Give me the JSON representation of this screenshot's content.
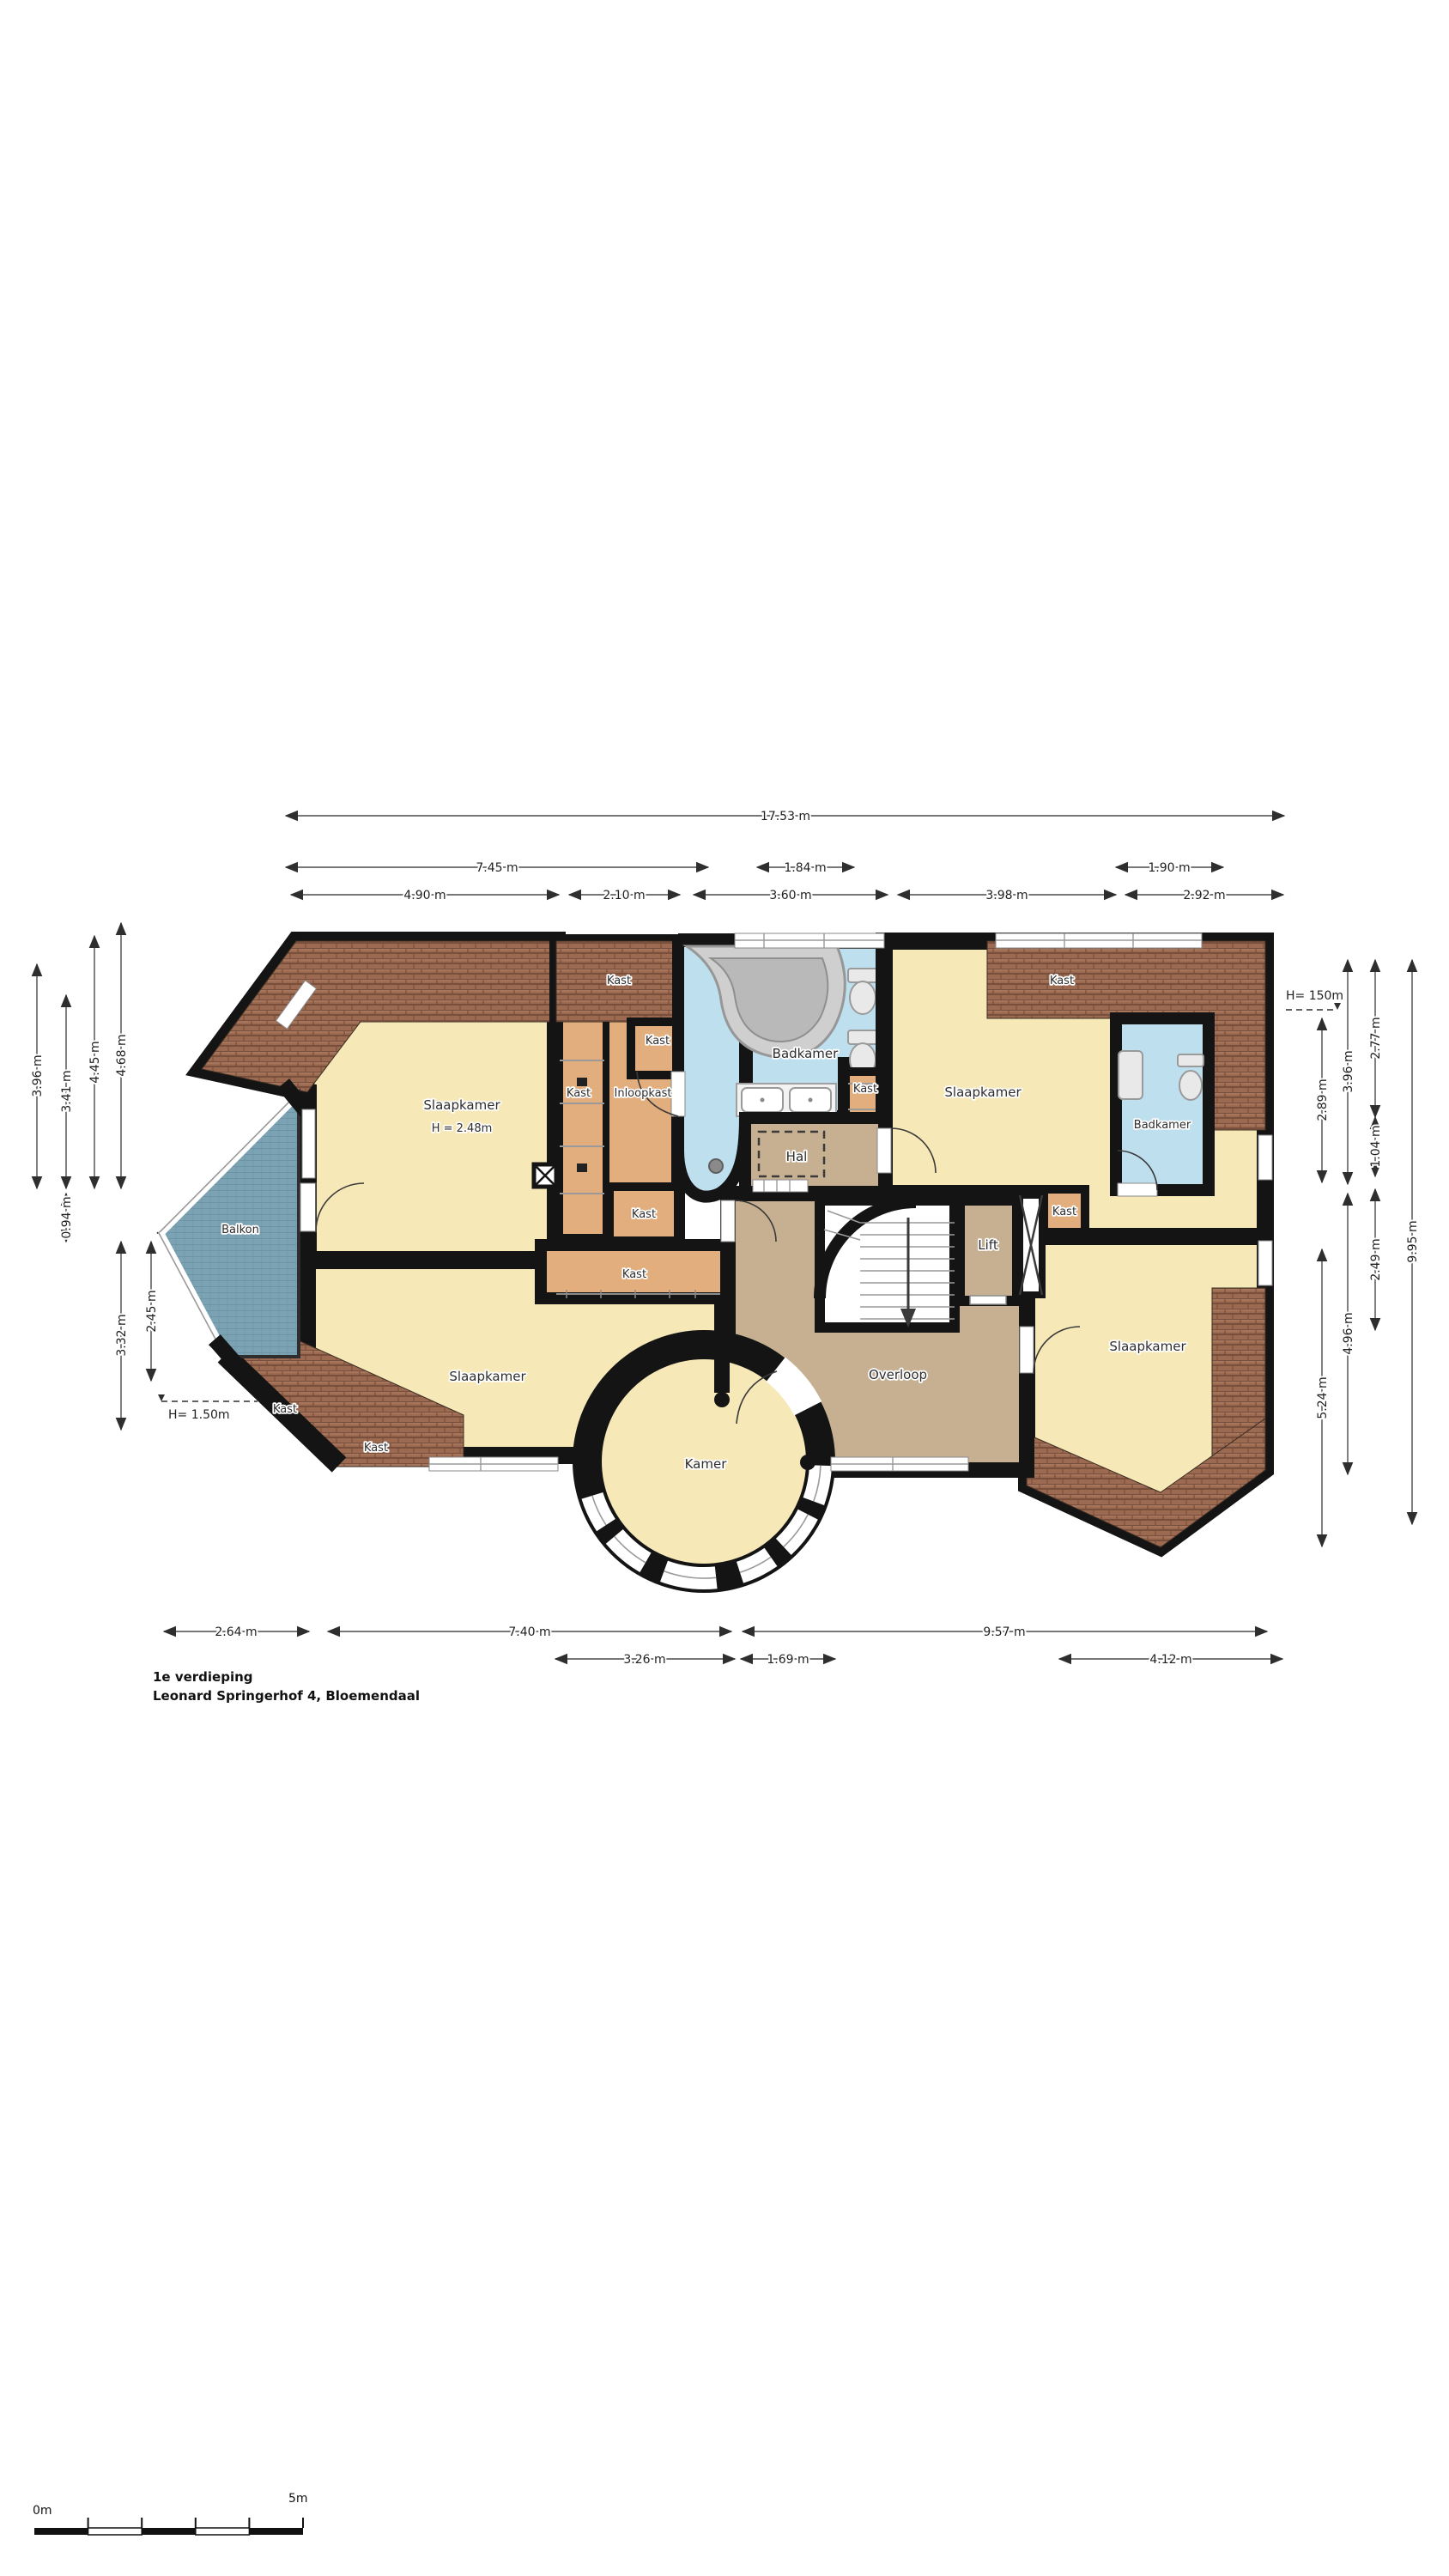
{
  "header": {
    "floor_title": "1e verdieping",
    "address": "Leonard Springerhof 4, Bloemendaal"
  },
  "scale_bar": {
    "start_label": "0m",
    "end_label": "5m"
  },
  "rooms": {
    "slaapkamer_nw": {
      "label": "Slaapkamer",
      "ceiling": "H = 2.48m"
    },
    "slaapkamer_ne": {
      "label": "Slaapkamer"
    },
    "slaapkamer_sw": {
      "label": "Slaapkamer"
    },
    "slaapkamer_se": {
      "label": "Slaapkamer"
    },
    "badkamer_main": {
      "label": "Badkamer"
    },
    "badkamer_east": {
      "label": "Badkamer"
    },
    "inloopkast": {
      "label": "Inloopkast"
    },
    "hal": {
      "label": "Hal"
    },
    "lift": {
      "label": "Lift"
    },
    "overloop": {
      "label": "Overloop"
    },
    "kamer": {
      "label": "Kamer"
    },
    "balkon": {
      "label": "Balkon"
    },
    "kast_roof_nw": {
      "label": "Kast"
    },
    "kast_top_small": {
      "label": "Kast"
    },
    "kast_left_strip": {
      "label": "Kast"
    },
    "kast_below_inloopkast": {
      "label": "Kast"
    },
    "kast_east_of_bath": {
      "label": "Kast"
    },
    "kast_roof_ne": {
      "label": "Kast"
    },
    "kast_below_badkamer_east": {
      "label": "Kast"
    },
    "kast_strip_sw": {
      "label": "Kast"
    },
    "kast_roof_sw_upper": {
      "label": "Kast"
    },
    "kast_roof_sw_lower": {
      "label": "Kast"
    }
  },
  "dimensions": {
    "top_total": "17.53 m",
    "top_row2": [
      "7.45 m",
      "1.84 m",
      "1.90 m"
    ],
    "top_row3": [
      "4.90 m",
      "2.10 m",
      "3.60 m",
      "3.98 m",
      "2.92 m"
    ],
    "bottom_row1": [
      "2.64 m",
      "7.40 m",
      "9.57 m"
    ],
    "bottom_row2": [
      "3.26 m",
      "1.69 m",
      "4.12 m"
    ],
    "left": [
      "3.96 m",
      "3.41 m",
      "4.45 m",
      "4.68 m",
      "0.94 m",
      "3.32 m",
      "2.45 m"
    ],
    "right": [
      "2.89 m",
      "5.24 m",
      "3.96 m",
      "4.96 m",
      "2.77 m",
      "1.04 m",
      "2.49 m",
      "9.95 m"
    ],
    "height_note_left": "H= 1.50m",
    "height_note_right": "H= 150m"
  },
  "colors": {
    "bedroom": "#f6e8b7",
    "closet": "#e2ae7e",
    "bathroom": "#bedfee",
    "hall": "#c7b091",
    "balcony": "#7ba3b3",
    "roof": "#9b6a50",
    "wall": "#141414"
  }
}
